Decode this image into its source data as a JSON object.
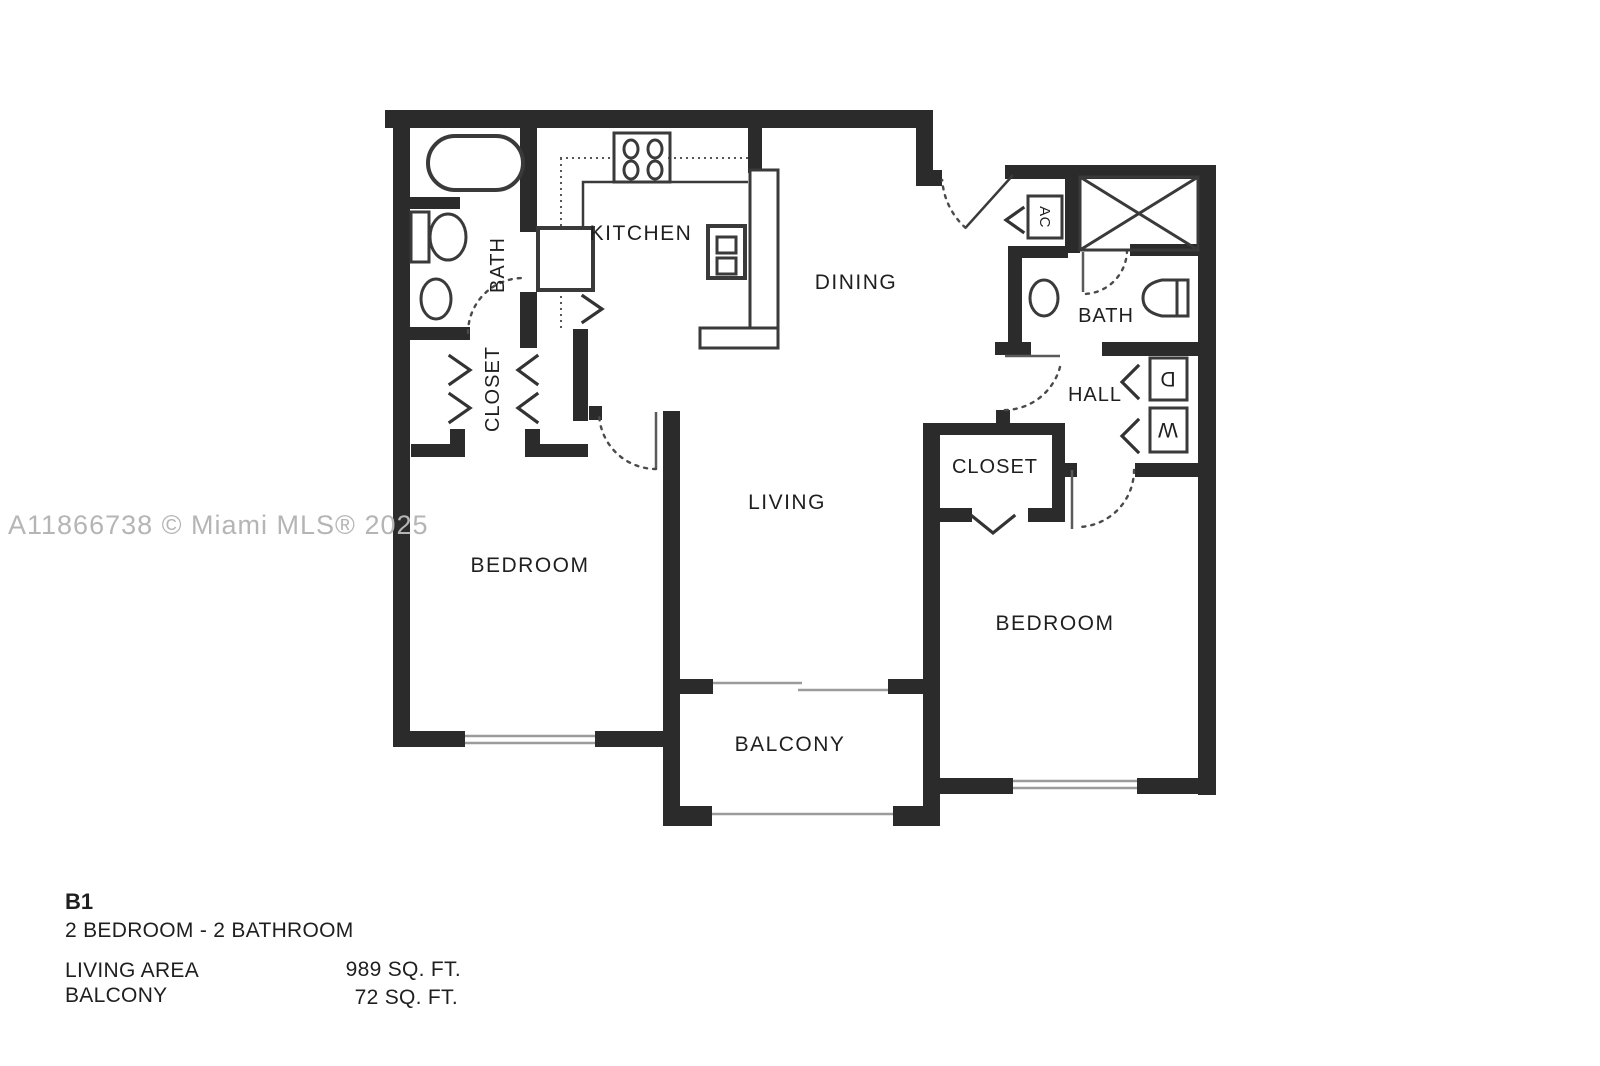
{
  "watermark": "A11866738 © Miami MLS® 2025",
  "floorplan": {
    "rooms": {
      "kitchen": "KITCHEN",
      "dining": "DINING",
      "living": "LIVING",
      "bedroom_left": "BEDROOM",
      "bedroom_right": "BEDROOM",
      "balcony": "BALCONY",
      "bath_left": "BATH",
      "bath_right": "BATH",
      "closet_left": "CLOSET",
      "closet_right": "CLOSET",
      "hall": "HALL"
    },
    "fixtures": {
      "ac": "AC",
      "dryer": "D",
      "washer": "W"
    }
  },
  "summary": {
    "plan_name": "B1",
    "plan_type": "2 BEDROOM - 2 BATHROOM",
    "living_area_label": "LIVING AREA",
    "living_area_value": "989 SQ. FT.",
    "balcony_label": "BALCONY",
    "balcony_value": "72 SQ. FT."
  },
  "colors": {
    "wall": "#2b2b2b",
    "fixture": "#3a3a3a",
    "thin": "#9b9b9b",
    "dash": "#4a4a4a",
    "text": "#1f1f1f",
    "watermark": "#b5b5b5",
    "background": "#ffffff"
  }
}
